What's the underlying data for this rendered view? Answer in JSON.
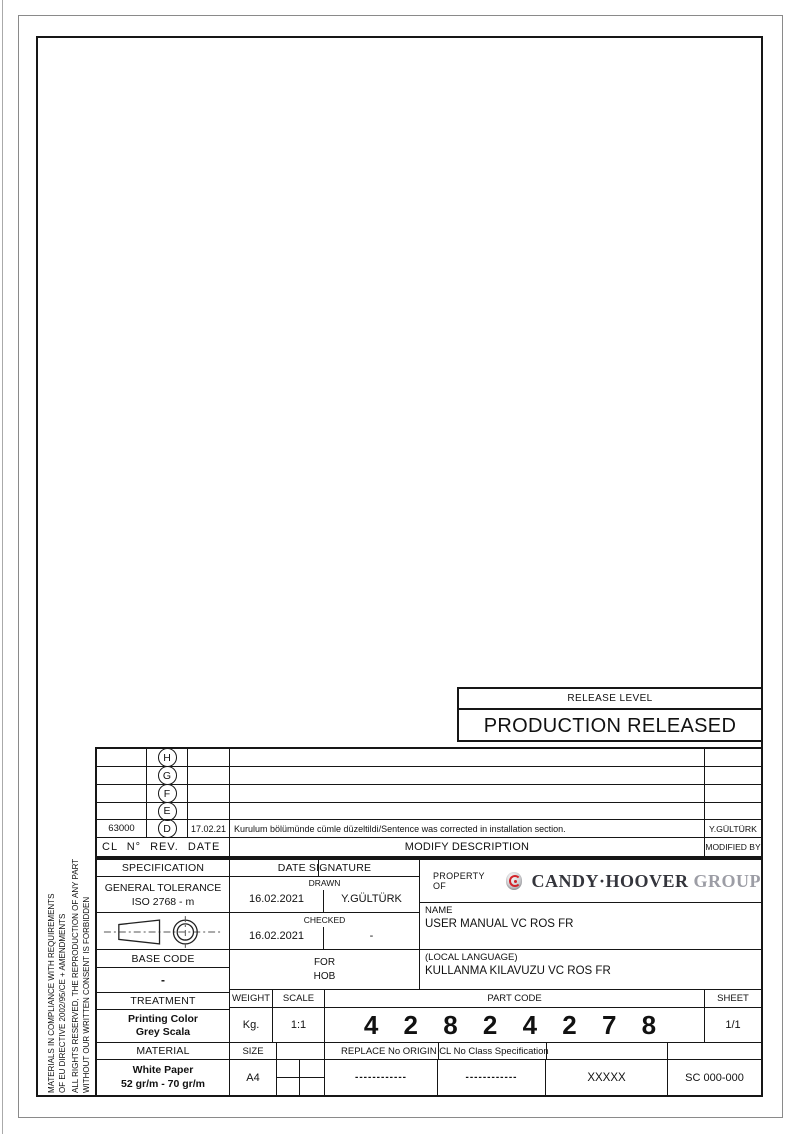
{
  "release_level": {
    "label": "RELEASE LEVEL",
    "status": "PRODUCTION RELEASED"
  },
  "revision_table": {
    "headers": {
      "left": "CL N° REV. DATE",
      "description": "MODIFY DESCRIPTION",
      "by": "MODIFIED BY"
    },
    "rows": [
      {
        "cl_no": "",
        "rev": "H",
        "date": "",
        "description": "",
        "by": ""
      },
      {
        "cl_no": "",
        "rev": "G",
        "date": "",
        "description": "",
        "by": ""
      },
      {
        "cl_no": "",
        "rev": "F",
        "date": "",
        "description": "",
        "by": ""
      },
      {
        "cl_no": "",
        "rev": "E",
        "date": "",
        "description": "",
        "by": ""
      },
      {
        "cl_no": "63000",
        "rev": "D",
        "date": "17.02.21",
        "description": "Kurulum bölümünde cümle düzeltildi/Sentence was corrected in installation section.",
        "by": "Y.GÜLTÜRK"
      }
    ]
  },
  "title_block": {
    "specification": {
      "header": "SPECIFICATION",
      "line1": "GENERAL TOLERANCE",
      "line2": "ISO 2768 - m"
    },
    "projection_symbol": "first-angle-projection",
    "signature": {
      "header": "DATE SIGNATURE",
      "drawn_label": "DRAWN",
      "drawn_date": "16.02.2021",
      "drawn_by": "Y.GÜLTÜRK",
      "checked_label": "CHECKED",
      "checked_date": "16.02.2021",
      "checked_by": "-"
    },
    "property": {
      "label": "PROPERTY OF",
      "brand": "CANDY·HOOVER",
      "brand_suffix": "GROUP"
    },
    "name": {
      "label": "NAME",
      "value": "USER MANUAL VC ROS FR"
    },
    "base_code": {
      "header": "BASE CODE",
      "value": "-"
    },
    "for_block": {
      "header": "FOR",
      "value": "HOB"
    },
    "local_language": {
      "label": "(LOCAL LANGUAGE)",
      "value": "KULLANMA KILAVUZU VC ROS FR"
    },
    "treatment": {
      "header": "TREATMENT",
      "line1": "Printing Color",
      "line2": "Grey Scala"
    },
    "weight": {
      "header": "WEIGHT",
      "value": "Kg."
    },
    "scale": {
      "header": "SCALE",
      "value": "1:1"
    },
    "part_code": {
      "header": "PART CODE",
      "value": "4 2 8 2 4 2 7 8"
    },
    "sheet": {
      "header": "SHEET",
      "value": "1/1"
    },
    "material": {
      "header": "MATERIAL",
      "line1": "White Paper",
      "line2": "52 gr/m - 70 gr/m"
    },
    "size": {
      "header": "SIZE",
      "value": "A4"
    },
    "replace_row": {
      "header": "REPLACE No ORIGIN CL No Class Specification",
      "replace_value": "------------",
      "origin_value": "------------",
      "class_value": "XXXXX",
      "spec_value": "SC 000-000"
    }
  },
  "compliance_notes": {
    "line1": "MATERIALS IN COMPLIANCE WITH REQUIREMENTS",
    "line2": "OF EU DIRECTIVE 2002/95/CE + AMENDMENTS",
    "line3": "ALL RIGHTS RESERVED, THE REPRODUCTION OF ANY PART",
    "line4": "WITHOUT OUR WRITTEN CONSENT IS FORBIDDEN"
  },
  "colors": {
    "line": "#161616",
    "accent_red": "#d2232a",
    "brand_dark": "#34353c",
    "brand_gray": "#9c9da5"
  }
}
